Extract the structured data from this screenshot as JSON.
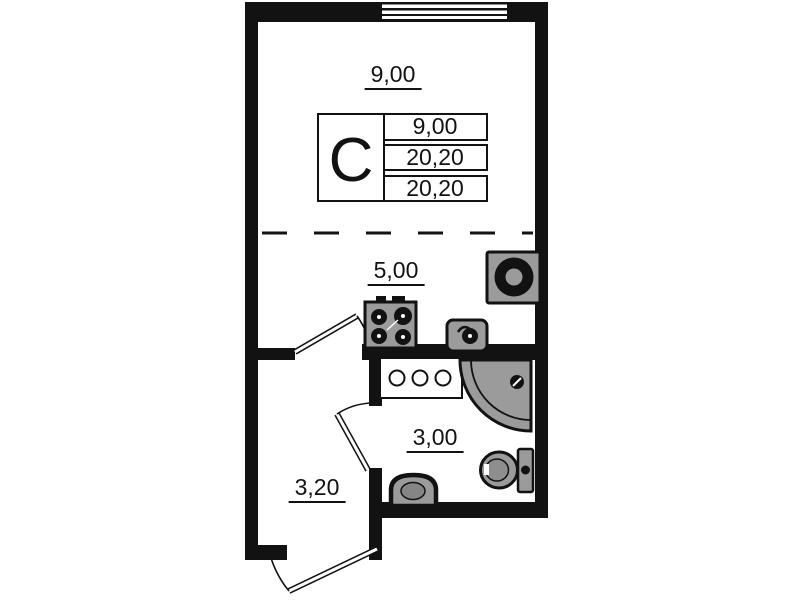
{
  "floor_plan": {
    "labels": {
      "main_room_area": "9,00",
      "kitchen_area": "5,00",
      "bathroom_area": "3,00",
      "hallway_area": "3,20"
    },
    "unit_table": {
      "unit_letter": "С",
      "rows": [
        "9,00",
        "20,20",
        "20,20"
      ]
    },
    "colors": {
      "wall": "#121212",
      "fixture_fill": "#9b9b9b",
      "background": "#ffffff"
    },
    "fixtures": [
      "window",
      "washing-machine",
      "stove",
      "kitchen-sink",
      "vanity-counter",
      "shower-cabin",
      "toilet",
      "washbasin",
      "kitchen-door",
      "bathroom-door",
      "entrance-door"
    ]
  }
}
